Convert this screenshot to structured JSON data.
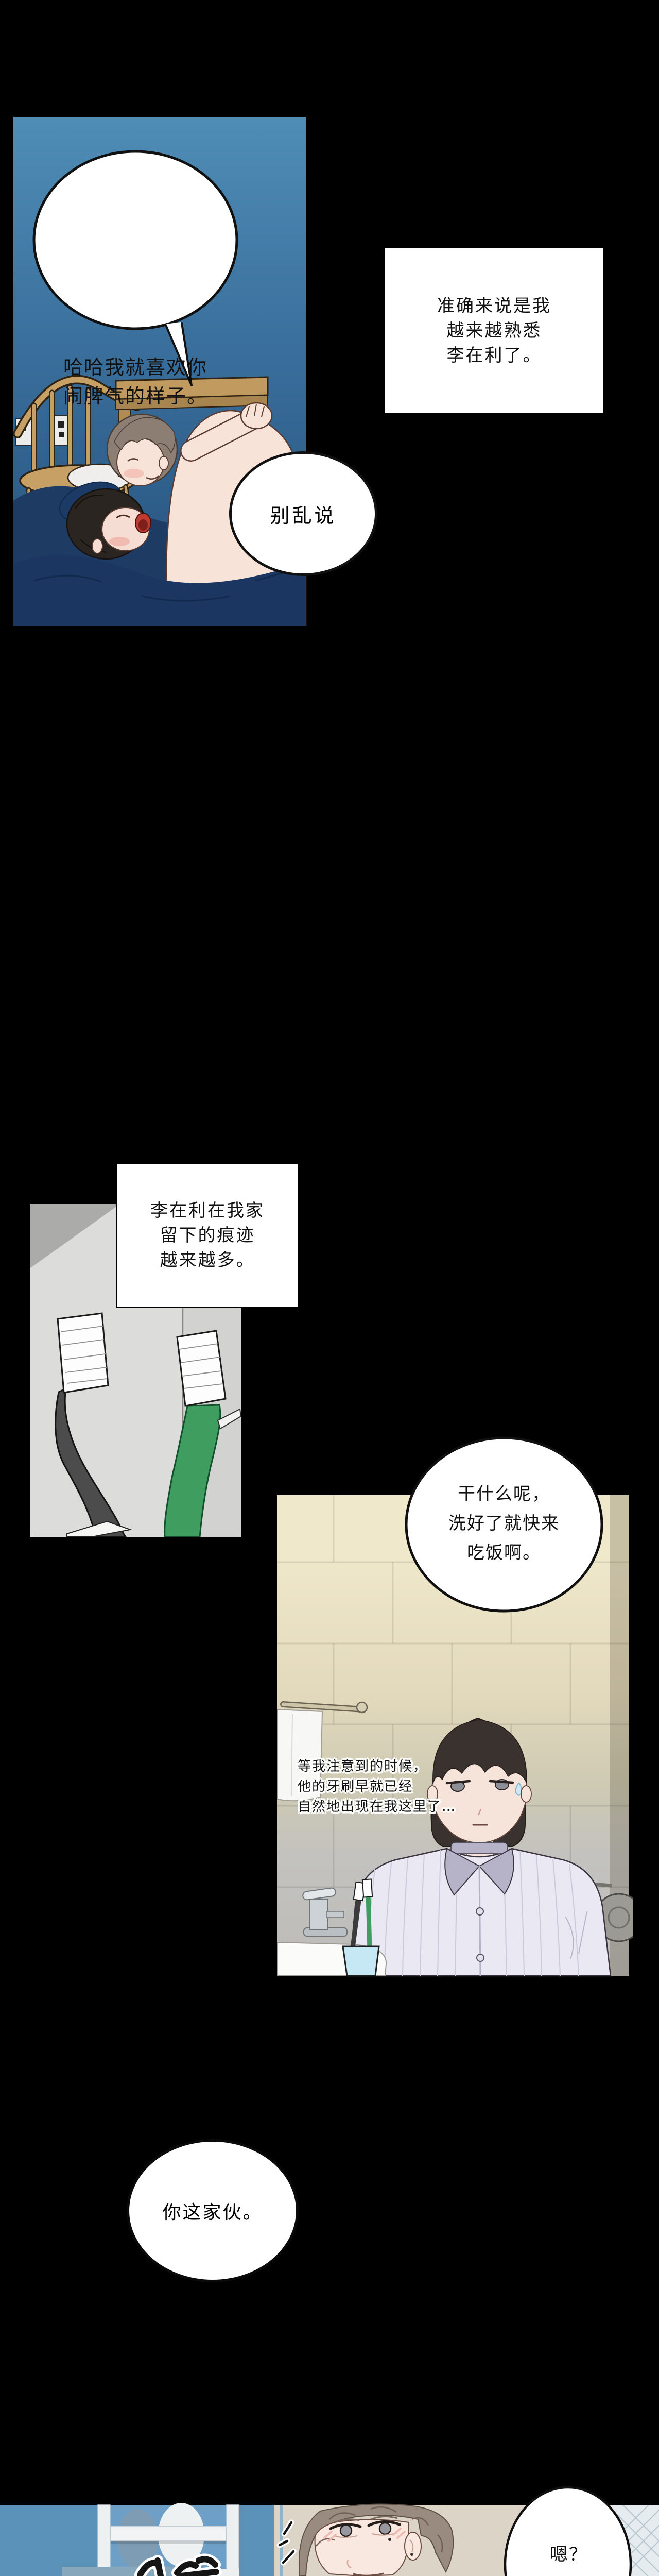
{
  "page": {
    "kind": "webtoon-comic-page",
    "background": "#000000"
  },
  "speech": {
    "bubble1": {
      "lines": [
        "哈哈我就喜欢你",
        "闹脾气的样子。"
      ]
    },
    "caption1": {
      "lines": [
        "准确来说是我",
        "越来越熟悉",
        "李在利了。"
      ]
    },
    "bubble2": {
      "lines": [
        "别乱说"
      ]
    },
    "caption2": {
      "lines": [
        "李在利在我家",
        "留下的痕迹",
        "越来越多。"
      ]
    },
    "bubble3": {
      "lines": [
        "干什么呢，",
        "洗好了就快来",
        "吃饭啊。"
      ]
    },
    "narration1": {
      "lines": [
        "等我注意到的时候，",
        "他的牙刷早就已经",
        "自然地出现在我这里了…"
      ]
    },
    "bubble4": {
      "lines": [
        "你这家伙。"
      ]
    },
    "bubble5": {
      "lines": [
        "嗯？"
      ]
    }
  },
  "colors": {
    "page_bg": "#000000",
    "bubble_fill": "#ffffff",
    "bubble_outline": "#111111",
    "panel1_bg_top": "#4f8db6",
    "panel1_bg_bottom": "#25507c",
    "bedding_navy": "#1e3b64",
    "wood_tan": "#c7a066",
    "skin": "#f7e3d8",
    "hair_gray_brown": "#8d7e74",
    "hair_black": "#2b2522",
    "panel2_bg": "#dcdcda",
    "toothbrush_dark": "#4c4c4c",
    "toothbrush_green": "#3f9e5f",
    "tile_beige": "#f0e8cb",
    "tile_gray": "#bcbbb7",
    "pajama_lavender": "#eae8f3",
    "pajama_collar": "#b6b3c9",
    "cup_blue": "#c6e7f4",
    "panel4_wall_blue": "#5b92ba",
    "panel4_wall_beige": "#dcd5c7"
  }
}
